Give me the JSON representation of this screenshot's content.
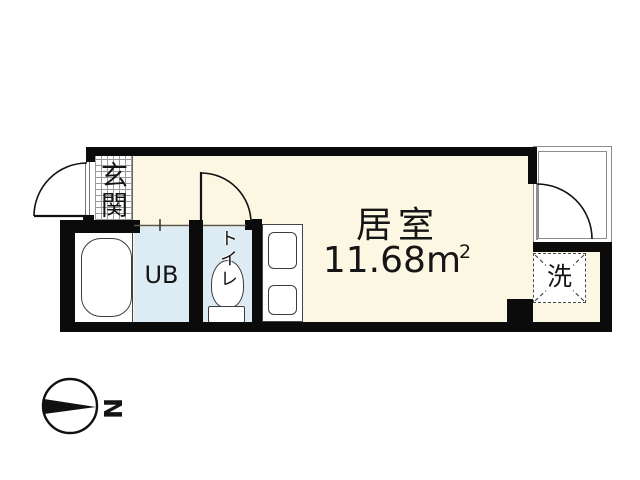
{
  "rooms": {
    "entrance": {
      "label": "玄関"
    },
    "unit_bath": {
      "label": "UB"
    },
    "toilet": {
      "label": "トイレ"
    },
    "living": {
      "label": "居室",
      "area_number": "11.68",
      "area_unit": "m",
      "area_exponent": "2"
    },
    "laundry": {
      "label": "洗"
    }
  },
  "compass": {
    "north_label": "N",
    "needle_direction": "right"
  },
  "colors": {
    "floor": "#FBF7E3",
    "wet_area": "#DCEBF4",
    "wall": "#0B0B0B",
    "fixture_outline": "#3C3C3C",
    "closet_outline": "#8D8D8D"
  }
}
